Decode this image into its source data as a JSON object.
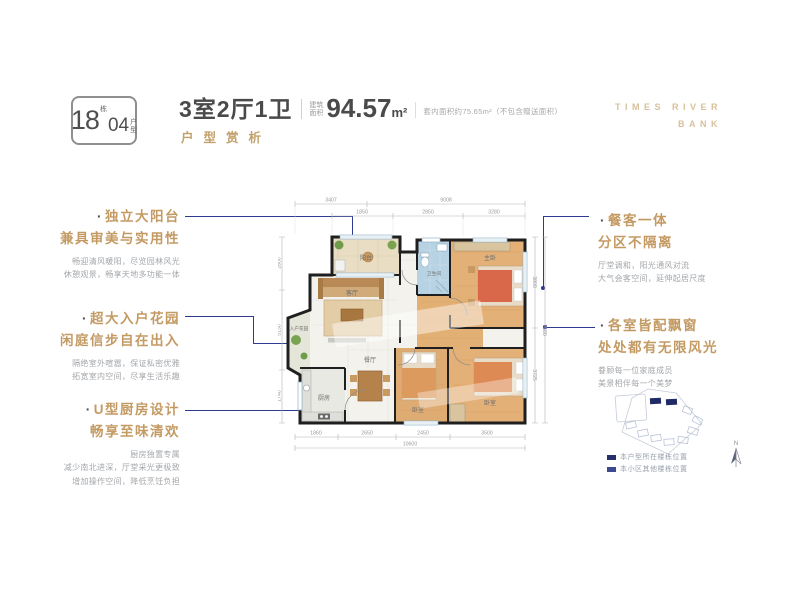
{
  "badge": {
    "block_number": "18",
    "block_suffix": "栋",
    "unit_number": "04",
    "unit_suffix_top": "户",
    "unit_suffix_bottom": "型"
  },
  "header": {
    "title": "3室2厅1卫",
    "area_label_top": "建筑",
    "area_label_bottom": "面积",
    "area_value": "94.57",
    "area_unit": "m²",
    "area_note": "套内面积约75.65m²（不包含赠送面积）",
    "subtitle": "户型赏析",
    "brand_line1": "TIMES RIVER",
    "brand_line2": "BANK"
  },
  "ui": {
    "bullet": "·"
  },
  "callouts_left": [
    {
      "title1": "独立大阳台",
      "title2": "兼具审美与实用性",
      "body": [
        "畅迎清风暖阳，尽览园林风光",
        "休憩观景，畅享天地多功能一体"
      ]
    },
    {
      "title1": "超大入户花园",
      "title2": "闲庭信步自在出入",
      "body": [
        "隔绝室外喧嚣，保证私密优雅",
        "拓宽室内空间，尽享生活乐趣"
      ]
    },
    {
      "title1": "U型厨房设计",
      "title2": "畅享至味清欢",
      "body": [
        "厨房独置专属",
        "减少南北进深，厅堂采光更极致",
        "增加操作空间，降低烹饪负担"
      ]
    }
  ],
  "callouts_right": [
    {
      "title1": "餐客一体",
      "title2": "分区不隔离",
      "body": [
        "厅堂调和，阳光通风对流",
        "大气会客空间，延伸起居尺度"
      ]
    },
    {
      "title1": "各室皆配飘窗",
      "title2": "处处都有无限风光",
      "body": [
        "眷顾每一位家庭成员",
        "美景相伴每一个美梦"
      ]
    }
  ],
  "floorplan": {
    "rooms": {
      "balcony": "阳台",
      "living": "客厅",
      "dining": "餐厅",
      "kitchen": "厨房",
      "entry_garden": "入户花园",
      "bathroom": "卫生间",
      "master_bedroom": "主卧",
      "bedroom2": "卧室",
      "bedroom3": "卧室"
    },
    "dims": {
      "top1": [
        "3407",
        "9008"
      ],
      "top2": [
        "1850",
        "2850",
        "3280"
      ],
      "bottom1": [
        "1860",
        "2650",
        "2450",
        "3500"
      ],
      "bottom_total": "10600",
      "right1": [
        "3800",
        "3725"
      ],
      "right_total": "7580",
      "left1": [
        "2800",
        "5130",
        "1740"
      ]
    }
  },
  "siteplan": {
    "legend": [
      {
        "label": "本户型所在楼栋位置"
      },
      {
        "label": "本小区其他楼栋位置"
      }
    ],
    "north": "N"
  },
  "colors": {
    "accent_gold": "#c49a63",
    "accent_navy": "#2e3b8e",
    "text_dark": "#4a4a4a"
  }
}
